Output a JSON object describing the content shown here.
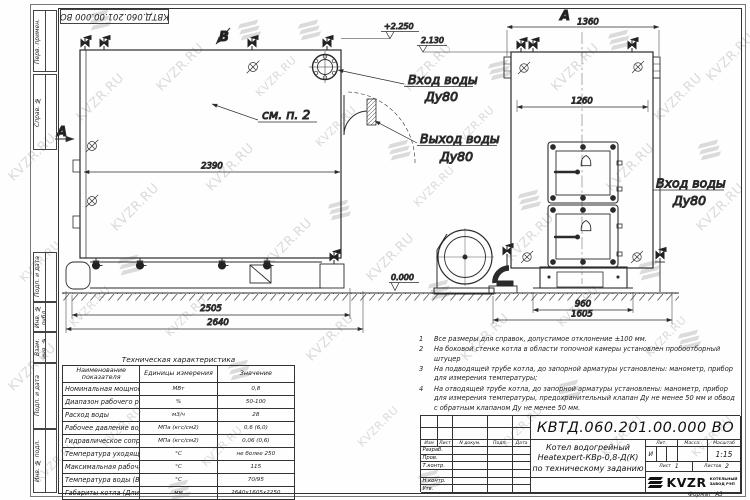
{
  "watermark": {
    "text": "KVZR.RU"
  },
  "frame": {
    "top_designation": "КВТД.060.201.00.000 ВО",
    "margin_labels": [
      "Перв. примен.",
      "Справ. №",
      "Подп. и дата",
      "Инв. № дубл.",
      "Взам. инв. №",
      "Подп. и дата",
      "Инв. № подл."
    ],
    "format_label": "Формат",
    "format_value": "А3"
  },
  "drawing": {
    "view_top_label": "В",
    "section_label": "А",
    "front_view_label": "А",
    "see_note": "см. п. 2",
    "inlet_top": {
      "l1": "Вход воды",
      "l2": "Ду80"
    },
    "outlet": {
      "l1": "Выход воды",
      "l2": "Ду80"
    },
    "inlet_side": {
      "l1": "Вход воды",
      "l2": "Ду80"
    },
    "elev_top": "+2.250",
    "elev_mid": "2.130",
    "elev_zero": "0.000",
    "dim_2390": "2390",
    "dim_2505": "2505",
    "dim_2640": "2640",
    "dim_1360": "1360",
    "dim_1260": "1260",
    "dim_960": "960",
    "dim_1605": "1605"
  },
  "tech_table": {
    "title": "Техническая характеристика",
    "col_name": "Наименование показателя",
    "col_units": "Единицы измерения",
    "col_value": "Значение",
    "rows": [
      {
        "name": "Номинальная мощность",
        "units": "МВт",
        "value": "0,8"
      },
      {
        "name": "Диапазон рабочего регулирования",
        "units": "%",
        "value": "50-100"
      },
      {
        "name": "Расход воды",
        "units": "м3/ч",
        "value": "28"
      },
      {
        "name": "Рабочее давление воды",
        "units": "МПа (кгс/см2)",
        "value": "0,6 (6,0)"
      },
      {
        "name": "Гидравлическое сопротивление котла",
        "units": "МПа (кгс/см2)",
        "value": "0,06 (0,6)"
      },
      {
        "name": "Температура уходящих газов",
        "units": "°С",
        "value": "не более 250"
      },
      {
        "name": "Максимальная рабочая температура воды",
        "units": "°С",
        "value": "115"
      },
      {
        "name": "Температура воды (Вход/выход)",
        "units": "°С",
        "value": "70/95"
      },
      {
        "name": "Габариты котла (Длинна х ширина х высота)",
        "units": "мм",
        "value": "2640х1605х2250"
      }
    ]
  },
  "notes": [
    {
      "num": "1",
      "text": "Все размеры для справок, допустимое отклонение ±100 мм."
    },
    {
      "num": "2",
      "text": "На боковой стенке котла в области топочной камеры установлен пробоотборный штуцер"
    },
    {
      "num": "3",
      "text": "На подводящей трубе котла, до запорной арматуры установлены: манометр, прибор для измерения температуры;"
    },
    {
      "num": "4",
      "text": "На отводящей трубе котла, до запорной арматуры установлены: манометр, прибор для измерения температуры, предохранительный клапан Ду не менее 50 мм и обвод с обратным клапаном Ду не менее 50 мм."
    }
  ],
  "title_block": {
    "designation": "КВТД.060.201.00.000 ВО",
    "name_l1": "Котел водогрейный",
    "name_l2": "Heatexpert-КВр-0,8-Д(К)",
    "name_l3": "по техническому заданию",
    "hdr_izm": "Изм",
    "hdr_list": "Лист",
    "hdr_doc": "N докум.",
    "hdr_podp": "Подп.",
    "hdr_data": "Дата",
    "rows": [
      "Разраб.",
      "Пров.",
      "Т.контр.",
      "",
      "Н.контр.",
      "Утв."
    ],
    "lit_label": "Лит.",
    "lit_value": "И",
    "mass_label": "Масса:",
    "scale_label": "Масштаб",
    "scale_value": "1:15",
    "sheet_label": "Лист",
    "sheet_value": "1",
    "sheets_label": "Листов",
    "sheets_value": "2",
    "logo": "KVZR",
    "logo_sub1": "КОТЕЛЬНЫЙ",
    "logo_sub2": "ЗАВОД РЭП"
  }
}
